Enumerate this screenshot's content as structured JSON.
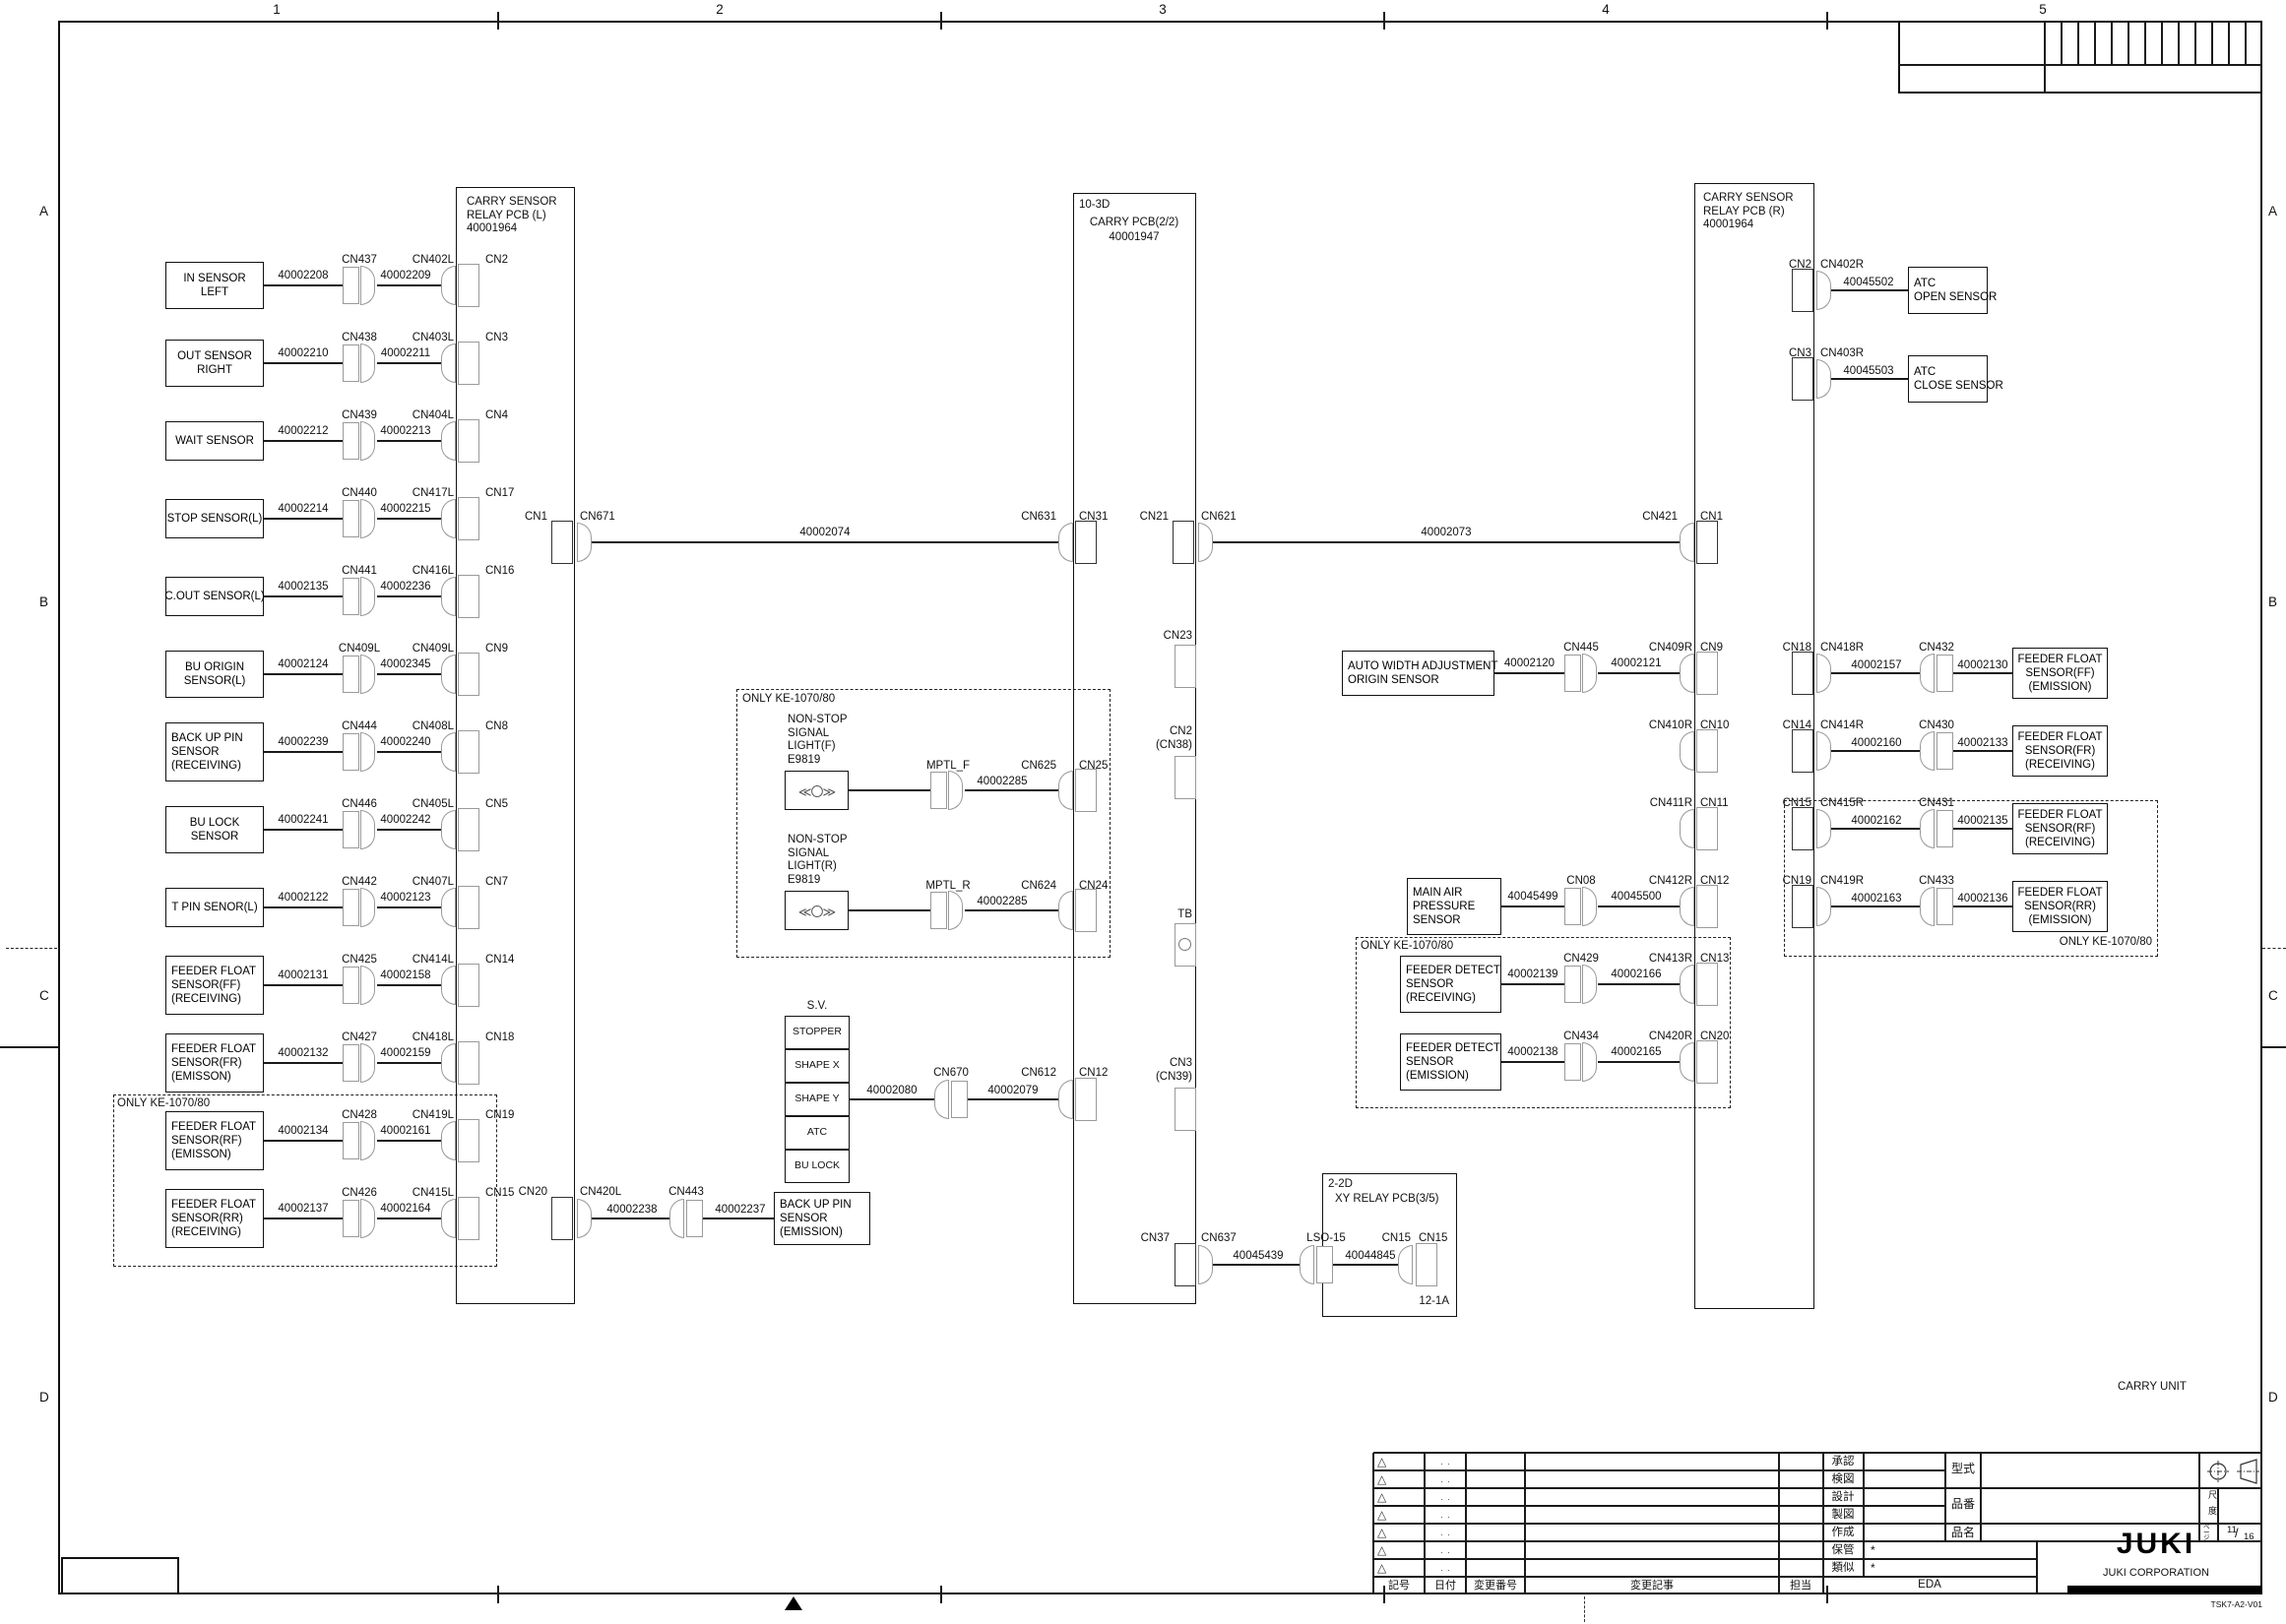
{
  "sheet": {
    "grid_columns": [
      "1",
      "2",
      "3",
      "4",
      "5"
    ],
    "grid_rows": [
      "A",
      "B",
      "C",
      "D"
    ],
    "unit_label": "CARRY UNIT",
    "drawing_code": "TSK7-A2-V01"
  },
  "pcbs": {
    "relay_l_title": "CARRY SENSOR\nRELAY PCB (L)\n40001964",
    "carry_tag": "10-3D",
    "carry_title": "CARRY PCB(2/2)",
    "carry_part": "40001947",
    "relay_r_title": "CARRY SENSOR\nRELAY PCB (R)\n40001964",
    "xy_tag": "2-2D",
    "xy_title": "XY RELAY PCB(3/5)",
    "xy_tag2": "12-1A"
  },
  "only_label": "ONLY KE-1070/80",
  "left_rows": [
    {
      "box": "IN SENSOR\nLEFT",
      "w1": "40002208",
      "cna": "CN437",
      "w2": "40002209",
      "cnb": "CN402L",
      "cnp": "CN2"
    },
    {
      "box": "OUT SENSOR\nRIGHT",
      "w1": "40002210",
      "cna": "CN438",
      "w2": "40002211",
      "cnb": "CN403L",
      "cnp": "CN3"
    },
    {
      "box": "WAIT SENSOR",
      "w1": "40002212",
      "cna": "CN439",
      "w2": "40002213",
      "cnb": "CN404L",
      "cnp": "CN4"
    },
    {
      "box": "STOP SENSOR(L)",
      "w1": "40002214",
      "cna": "CN440",
      "w2": "40002215",
      "cnb": "CN417L",
      "cnp": "CN17"
    },
    {
      "box": "C.OUT SENSOR(L)",
      "w1": "40002135",
      "cna": "CN441",
      "w2": "40002236",
      "cnb": "CN416L",
      "cnp": "CN16"
    },
    {
      "box": "BU ORIGIN\nSENSOR(L)",
      "w1": "40002124",
      "cna": "CN409L",
      "w2": "40002345",
      "cnb": "CN409L",
      "cnp": "CN9"
    },
    {
      "box": "BACK UP PIN\nSENSOR\n(RECEIVING)",
      "w1": "40002239",
      "cna": "CN444",
      "w2": "40002240",
      "cnb": "CN408L",
      "cnp": "CN8"
    },
    {
      "box": "BU LOCK\nSENSOR",
      "w1": "40002241",
      "cna": "CN446",
      "w2": "40002242",
      "cnb": "CN405L",
      "cnp": "CN5"
    },
    {
      "box": "T PIN SENOR(L)",
      "w1": "40002122",
      "cna": "CN442",
      "w2": "40002123",
      "cnb": "CN407L",
      "cnp": "CN7"
    },
    {
      "box": "FEEDER FLOAT\nSENSOR(FF)\n(RECEIVING)",
      "w1": "40002131",
      "cna": "CN425",
      "w2": "40002158",
      "cnb": "CN414L",
      "cnp": "CN14"
    },
    {
      "box": "FEEDER FLOAT\nSENSOR(FR)\n(EMISSON)",
      "w1": "40002132",
      "cna": "CN427",
      "w2": "40002159",
      "cnb": "CN418L",
      "cnp": "CN18"
    },
    {
      "box": "FEEDER FLOAT\nSENSOR(RF)\n(EMISSON)",
      "w1": "40002134",
      "cna": "CN428",
      "w2": "40002161",
      "cnb": "CN419L",
      "cnp": "CN19"
    },
    {
      "box": "FEEDER FLOAT\nSENSOR(RR)\n(RECEIVING)",
      "w1": "40002137",
      "cna": "CN426",
      "w2": "40002164",
      "cnb": "CN415L",
      "cnp": "CN15"
    }
  ],
  "trunk_l": {
    "cn1": "CN1",
    "cn2": "CN671",
    "wire": "40002074",
    "cn3": "CN631",
    "cn4": "CN31"
  },
  "trunk_m": {
    "cn1": "CN21",
    "cn2": "CN621",
    "wire": "40002073",
    "cn3": "CN421",
    "cn4": "CN1"
  },
  "carry_stubs_right": [
    {
      "label": "CN23"
    },
    {
      "label": "CN2\n(CN38)"
    },
    {
      "label": "TB",
      "circle": true
    },
    {
      "label": "CN3\n(CN39)"
    }
  ],
  "nonstop_rows": [
    {
      "label": "NON-STOP\nSIGNAL\nLIGHT(F)\nE9819",
      "lamp": "≪〇≫",
      "cn": "MPTL_F",
      "wire": "40002285",
      "cnb": "CN625",
      "cnp": "CN25"
    },
    {
      "label": "NON-STOP\nSIGNAL\nLIGHT(R)\nE9819",
      "lamp": "≪〇≫",
      "cn": "MPTL_R",
      "wire": "40002285",
      "cnb": "CN624",
      "cnp": "CN24"
    }
  ],
  "sv": {
    "title": "S.V.",
    "items": [
      "STOPPER",
      "SHAPE X",
      "SHAPE Y",
      "ATC",
      "BU LOCK"
    ],
    "w1": "40002080",
    "cn": "CN670",
    "w2": "40002079",
    "cnb": "CN612",
    "cnp": "CN12"
  },
  "backup": {
    "cnp": "CN20",
    "cna": "CN420L",
    "w1": "40002238",
    "cn": "CN443",
    "w2": "40002237",
    "box": "BACK UP PIN\nSENSOR\n(EMISSION)"
  },
  "xy_link": {
    "cnp": "CN37",
    "cna": "CN637",
    "w1": "40045439",
    "cn": "LSO-15",
    "w2": "40044845",
    "cnb": "CN15",
    "cnp2": "CN15"
  },
  "mid_rows": [
    {
      "box": "AUTO WIDTH ADJUSTMENT\nORIGIN SENSOR",
      "w1": "40002120",
      "cn": "CN445",
      "w2": "40002121",
      "cnr": "CN409R",
      "cnp": "CN9"
    },
    {
      "cnr": "CN410R",
      "cnp": "CN10"
    },
    {
      "cnr": "CN411R",
      "cnp": "CN11"
    },
    {
      "box": "MAIN AIR\nPRESSURE\nSENSOR",
      "w1": "40045499",
      "cn": "CN08",
      "w2": "40045500",
      "cnr": "CN412R",
      "cnp": "CN12"
    },
    {
      "box": "FEEDER DETECT\nSENSOR\n(RECEIVING)",
      "w1": "40002139",
      "cn": "CN429",
      "w2": "40002166",
      "cnr": "CN413R",
      "cnp": "CN13"
    },
    {
      "box": "FEEDER DETECT\nSENSOR\n(EMISSION)",
      "w1": "40002138",
      "cn": "CN434",
      "w2": "40002165",
      "cnr": "CN420R",
      "cnp": "CN20"
    }
  ],
  "right_rows": [
    {
      "cnin": "CN18",
      "cnout": "CN418R",
      "w1": "40002157",
      "cn": "CN432",
      "w2": "40002130",
      "box": "FEEDER FLOAT\nSENSOR(FF)\n(EMISSION)"
    },
    {
      "cnin": "CN14",
      "cnout": "CN414R",
      "w1": "40002160",
      "cn": "CN430",
      "w2": "40002133",
      "box": "FEEDER FLOAT\nSENSOR(FR)\n(RECEIVING)"
    },
    {
      "cnin": "CN15",
      "cnout": "CN415R",
      "w1": "40002162",
      "cn": "CN431",
      "w2": "40002135",
      "box": "FEEDER FLOAT\nSENSOR(RF)\n(RECEIVING)"
    },
    {
      "cnin": "CN19",
      "cnout": "CN419R",
      "w1": "40002163",
      "cn": "CN433",
      "w2": "40002136",
      "box": "FEEDER FLOAT\nSENSOR(RR)\n(EMISSION)"
    }
  ],
  "atc_rows": [
    {
      "cnin": "CN2",
      "cnout": "CN402R",
      "w1": "40045502",
      "box": "ATC\nOPEN SENSOR"
    },
    {
      "cnin": "CN3",
      "cnout": "CN403R",
      "w1": "40045503",
      "box": "ATC\nCLOSE SENSOR"
    }
  ],
  "title_block": {
    "revision_header": [
      "記号",
      "日付",
      "変更番号",
      "変更記事",
      "担当"
    ],
    "revision_mark": "△",
    "revision_dots": ".  .",
    "approval_labels": [
      "承認",
      "検図",
      "設計",
      "製図",
      "作成"
    ],
    "storage_label": "保管",
    "storage_value": "*",
    "similar_label": "類似",
    "similar_value": "*",
    "dept": "EDA",
    "model_label": "型式",
    "part_no_label": "品番",
    "part_name_label": "品名",
    "scale_label": "尺度",
    "page_label": "ページ",
    "page_current": "11",
    "page_total": "16",
    "brand": "JUKI",
    "brand_sub": "JUKI CORPORATION"
  }
}
